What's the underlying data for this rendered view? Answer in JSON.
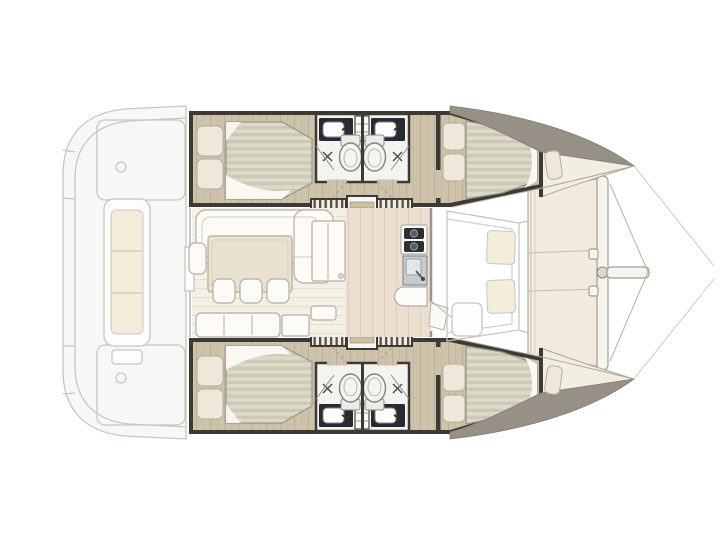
{
  "meta": {
    "description": "Top-view interior floor plan of a sailing catamaran: two hulls each with an aft double cabin, two bathrooms, companionway steps and a forward double cabin with forepeak; central saloon with dinette, galley and bench; aft cockpit and forward cockpit drawn ghosted; foredeck with crossbeam, bowsprit and rigging wires."
  },
  "colors": {
    "bg": "#ffffff",
    "wall": "#3d3933",
    "ghost_stroke": "#c7c6c3",
    "ghost_fill": "#f7f7f5",
    "ghost_cushion": "#f3edda",
    "wood": "#cdc3ab",
    "wood_line": "#b8ae94",
    "wood_light": "#ecdfd1",
    "wood_light_line": "#dccfbc",
    "saloon_floor": "#f4f0e6",
    "saloon_floor_line": "#e7e0cf",
    "mattress_a": "#dcd9c8",
    "mattress_b": "#ccc9b7",
    "sheet": "#f9f8f3",
    "pillow": "#ede8d9",
    "pillow_stroke": "#b4ae9d",
    "furn_white": "#fcfbf8",
    "furn_stroke": "#b2aea4",
    "table": "#e9e2cf",
    "table_stroke": "#b1aa94",
    "counter_dark": "#272c34",
    "steel": "#c7cbce",
    "toilet": "#f4f4f1",
    "toilet_stroke": "#83827e",
    "deck_gray": "#969087",
    "bow_cream": "#f2eee2",
    "foredeck": "#f1ebde",
    "stair_a": "#f0ede4",
    "stair_b": "#57514a"
  },
  "areas": {
    "aft_cockpit": {
      "label": "Aft cockpit with bench seat and stern platforms (ghosted exterior)"
    },
    "hull_top": {
      "label": "Upper hull: aft double cabin, two bathrooms, companionway steps, forward double cabin and forepeak"
    },
    "hull_bottom": {
      "label": "Lower hull: mirrored layout with aft double cabin, two bathrooms, companionway steps, forward double cabin and forepeak"
    },
    "saloon": {
      "label": "Main saloon"
    },
    "dinette": {
      "label": "Dinette with L-shaped sofa, table and three chairs"
    },
    "galley": {
      "label": "Galley with two-burner stove, sink and rounded worktop"
    },
    "nav_bench": {
      "label": "Aft bench seat with side cabinet"
    },
    "forward_cockpit": {
      "label": "Forward cockpit bench with two cushions (ghosted exterior)"
    },
    "foredeck": {
      "label": "Foredeck with forward crossbeam, bowsprit and rigging wires"
    }
  },
  "rooms": {
    "aft_cabin": {
      "label": "Aft double cabin with island bed and two pillows"
    },
    "forward_cabin": {
      "label": "Forward double cabin with tapered double bed"
    },
    "bathroom_aft": {
      "label": "Aft bathroom with vanity sink, toilet and shower"
    },
    "bathroom_fwd": {
      "label": "Forward bathroom with vanity sink, toilet and shower"
    },
    "companionway": {
      "label": "Companionway steps and ladder down from the saloon"
    },
    "forepeak": {
      "label": "Forepeak berth in the bow"
    }
  }
}
